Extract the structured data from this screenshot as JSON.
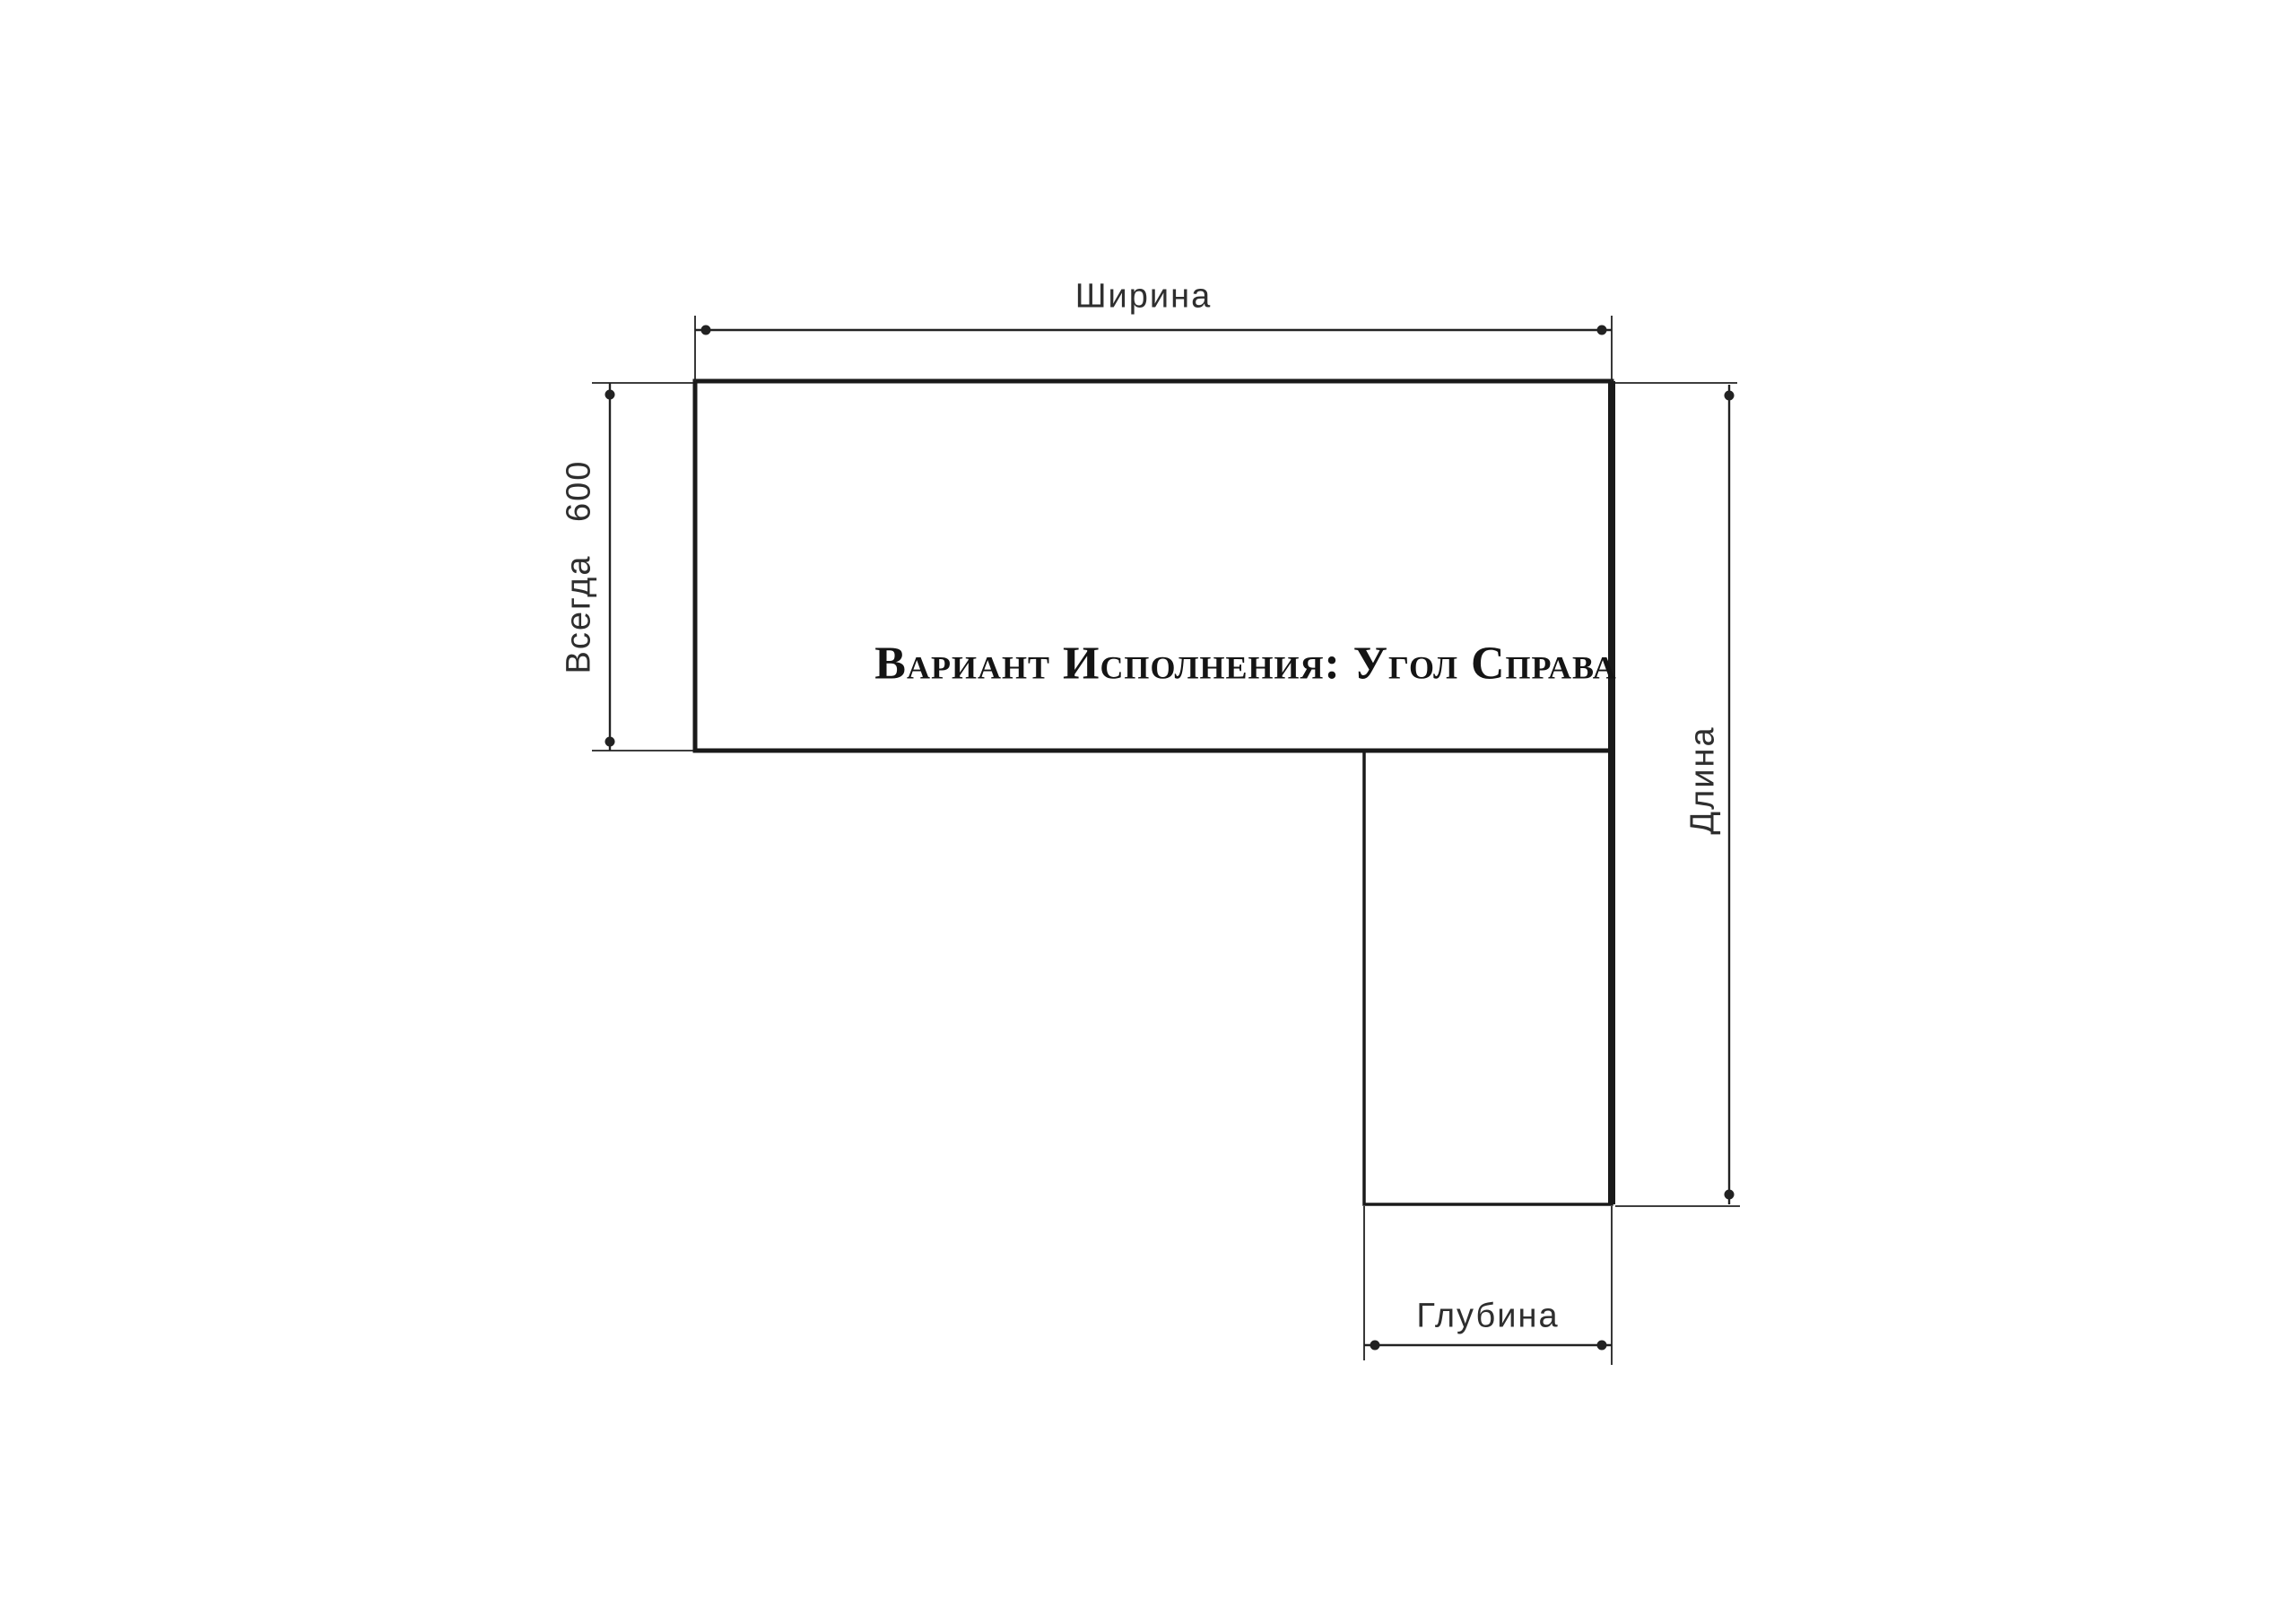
{
  "diagram": {
    "title": "Вариант Исполнения: Угол Справа",
    "labels": {
      "width": "Ширина",
      "always_600": "Всегда 600",
      "length": "Длина",
      "depth": "Глубина"
    },
    "colors": {
      "outline": "#1a1a1a",
      "dimension_line": "#222222",
      "label_text": "#2e2e2e",
      "title_text": "#141414",
      "background": "#ffffff"
    }
  }
}
